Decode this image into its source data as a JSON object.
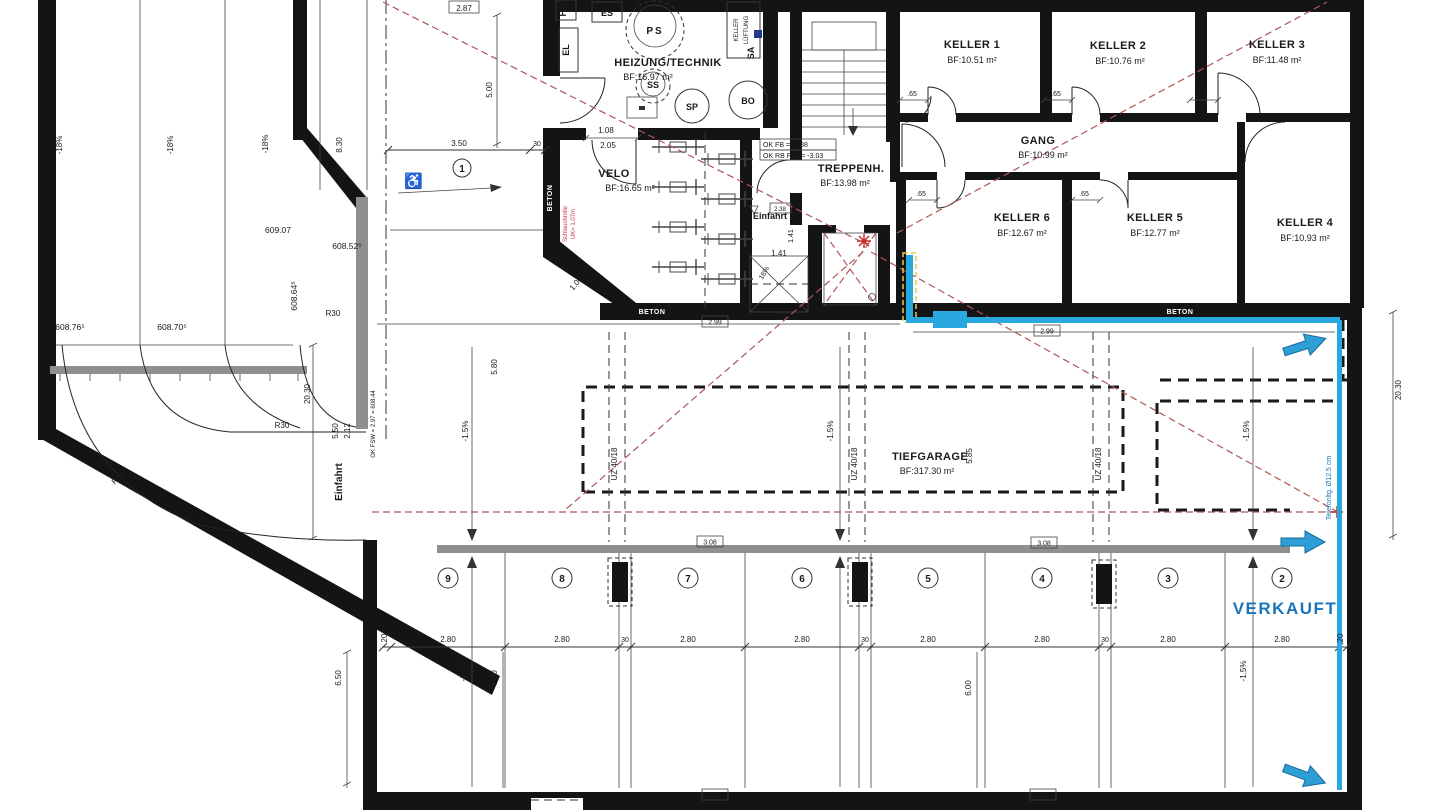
{
  "rooms": {
    "heizung": {
      "name": "HEIZUNG/TECHNIK",
      "area": "BF:16.97 m²"
    },
    "velo": {
      "name": "VELO",
      "area": "BF:16.65 m²"
    },
    "treppenhaus": {
      "name": "TREPPENH.",
      "area": "BF:13.98 m²"
    },
    "gang": {
      "name": "GANG",
      "area": "BF:10.99 m²"
    },
    "keller1": {
      "name": "KELLER 1",
      "area": "BF:10.51 m²"
    },
    "keller2": {
      "name": "KELLER 2",
      "area": "BF:10.76 m²"
    },
    "keller3": {
      "name": "KELLER 3",
      "area": "BF:11.48 m²"
    },
    "keller4": {
      "name": "KELLER 4",
      "area": "BF:10.93 m²"
    },
    "keller5": {
      "name": "KELLER 5",
      "area": "BF:12.77 m²"
    },
    "keller6": {
      "name": "KELLER 6",
      "area": "BF:12.67 m²"
    },
    "tiefgarage": {
      "name": "TIEFGARAGE",
      "area": "BF:317.30 m²"
    }
  },
  "equipment": {
    "es": "ES",
    "ha": "HA",
    "el": "EL",
    "sa": "SA",
    "ps": "PS",
    "ss": "SS",
    "sp": "SP",
    "bo": "BO",
    "keller_lueftung_1": "KELLER",
    "keller_lueftung_2": "LÜFTUNG"
  },
  "labels": {
    "einfahrt": "Einfahrt",
    "verkauft": "VERKAUFT",
    "beton": "BETON",
    "schlauchrolle": "Schlauchrolle",
    "schlauchrolle_uk": "UK= 1.07m",
    "telefon": "Telefonltg. Ø12.5 cm",
    "uz": "UZ 40/18",
    "ok_fb": "OK FB = -2.88",
    "ok_fpl": "OK RB FPL = -3.03",
    "ok_fsw": "OK FSW = 2.97 = 608.44"
  },
  "levels": {
    "l609_07": "609.07",
    "l608_52": "608.52⁵",
    "l608_64": "608.64⁵",
    "l608_76": "608.76⁵",
    "l608_70": "608.70⁵"
  },
  "slopes": {
    "ramp": "-18%",
    "garage": "-1.5%",
    "einfahrt_ramp": "16%"
  },
  "radii": {
    "r30": "R30",
    "r50": "R50"
  },
  "dims": {
    "d287": "2.87",
    "d830": "8.30",
    "d500": "5.00",
    "d350": "3.50",
    "d30": "30",
    "d20": "20",
    "d2030": "20.30",
    "d550": "5.50",
    "d212": "2.12",
    "d108": "1.08",
    "d205": "2.05",
    "d100": "1.00",
    "d141": "1.41",
    "d65": ".65",
    "d238": "2.38",
    "d280": "2.80",
    "d299": "2.99",
    "d308": "3.08",
    "d580": "5.80",
    "d585": "5.85",
    "d600": "6.00",
    "d650": "6.50"
  },
  "parking": {
    "p1": "1",
    "p2": "2",
    "p3": "3",
    "p4": "4",
    "p5": "5",
    "p6": "6",
    "p7": "7",
    "p8": "8",
    "p9": "9"
  },
  "colors": {
    "pipe_blue": "#29a8e0",
    "verkauft_blue": "#1b75bb",
    "survey_red": "#b05555",
    "wall_black": "#141414",
    "concrete_gray": "#8f8f8f",
    "note_red": "#cc3344"
  }
}
